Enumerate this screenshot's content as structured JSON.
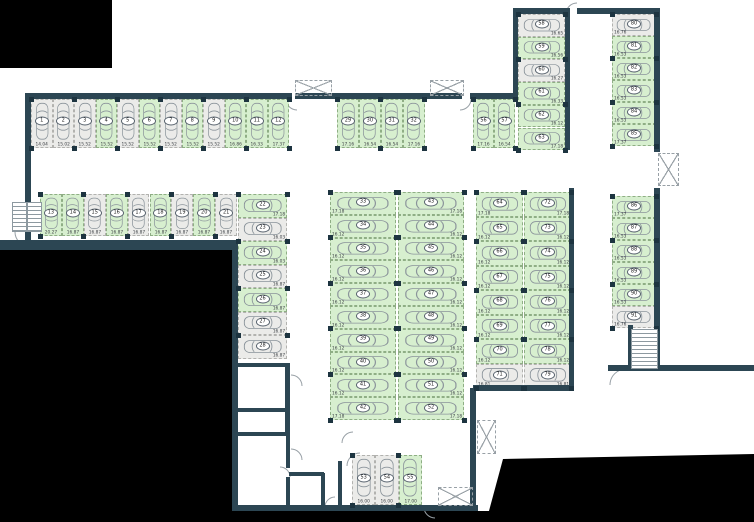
{
  "title": "Parking garage floor plan",
  "colors": {
    "free_space": "#d7efcf",
    "occupied_space": "#ebebe9",
    "wall": "#2c4653",
    "void": "#000000",
    "car_outline": "#8b949b",
    "dim_text": "#3d4146"
  },
  "icons": {
    "car": "car-icon",
    "stairs": "stairs-icon",
    "shaft": "shaft-icon",
    "door": "door-arc"
  },
  "blocks": [
    {
      "id": "row-top",
      "x": 31,
      "y": 99,
      "cw": 21.5,
      "ch": 49,
      "axis": "h",
      "dim": "bc",
      "spaces": [
        {
          "n": 1,
          "d": "14.04",
          "f": 0
        },
        {
          "n": 2,
          "d": "15.02",
          "f": 0
        },
        {
          "n": 3,
          "d": "15.52",
          "f": 0
        },
        {
          "n": 4,
          "d": "15.52",
          "f": 1
        },
        {
          "n": 5,
          "d": "15.52",
          "f": 0
        },
        {
          "n": 6,
          "d": "15.52",
          "f": 1
        },
        {
          "n": 7,
          "d": "15.52",
          "f": 0
        },
        {
          "n": 8,
          "d": "15.52",
          "f": 1
        },
        {
          "n": 9,
          "d": "15.52",
          "f": 0
        },
        {
          "n": 10,
          "d": "16.86",
          "f": 1
        },
        {
          "n": 11,
          "d": "16.33",
          "f": 1
        },
        {
          "n": 12,
          "d": "17.37",
          "f": 1
        }
      ]
    },
    {
      "id": "row-second",
      "x": 40,
      "y": 194,
      "cw": 21.9,
      "ch": 42,
      "axis": "h",
      "dim": "bc",
      "spaces": [
        {
          "n": 13,
          "d": "20.27",
          "f": 1
        },
        {
          "n": 14,
          "d": "16.87",
          "f": 1
        },
        {
          "n": 15,
          "d": "16.87",
          "f": 0
        },
        {
          "n": 16,
          "d": "16.87",
          "f": 1
        },
        {
          "n": 17,
          "d": "16.87",
          "f": 0
        },
        {
          "n": 18,
          "d": "16.87",
          "f": 1
        },
        {
          "n": 19,
          "d": "16.87",
          "f": 0
        },
        {
          "n": 20,
          "d": "16.87",
          "f": 1
        },
        {
          "n": 21,
          "d": "16.87",
          "f": 0
        }
      ]
    },
    {
      "id": "col-left",
      "x": 238,
      "y": 194,
      "cw": 49,
      "ch": 23.5,
      "axis": "v",
      "dim": "br",
      "spaces": [
        {
          "n": 22,
          "d": "17.18",
          "f": 1
        },
        {
          "n": 23,
          "d": "16.03",
          "f": 0
        },
        {
          "n": 24,
          "d": "16.03",
          "f": 1
        },
        {
          "n": 25,
          "d": "16.87",
          "f": 0
        },
        {
          "n": 26,
          "d": "16.87",
          "f": 1
        },
        {
          "n": 27,
          "d": "16.87",
          "f": 0
        },
        {
          "n": 28,
          "d": "16.87",
          "f": 0
        }
      ]
    },
    {
      "id": "row-mid-top",
      "x": 337,
      "y": 99,
      "cw": 21.9,
      "ch": 49,
      "axis": "h",
      "dim": "bc",
      "spaces": [
        {
          "n": 29,
          "d": "17.16",
          "f": 1
        },
        {
          "n": 30,
          "d": "16.54",
          "f": 1
        },
        {
          "n": 31,
          "d": "16.54",
          "f": 1
        },
        {
          "n": 32,
          "d": "17.16",
          "f": 1
        }
      ]
    },
    {
      "id": "block-mid-left",
      "x": 330,
      "y": 192,
      "cw": 66,
      "ch": 22.8,
      "axis": "v",
      "dim": "bl",
      "spaces": [
        {
          "n": 33,
          "d": "17.18",
          "f": 1
        },
        {
          "n": 34,
          "d": "16.12",
          "f": 1
        },
        {
          "n": 35,
          "d": "16.12",
          "f": 1
        },
        {
          "n": 36,
          "d": "16.12",
          "f": 1
        },
        {
          "n": 37,
          "d": "16.12",
          "f": 1
        },
        {
          "n": 38,
          "d": "16.12",
          "f": 1
        },
        {
          "n": 39,
          "d": "16.12",
          "f": 1
        },
        {
          "n": 40,
          "d": "16.12",
          "f": 1
        },
        {
          "n": 41,
          "d": "16.12",
          "f": 1
        },
        {
          "n": 42,
          "d": "17.18",
          "f": 1
        }
      ]
    },
    {
      "id": "block-mid-right",
      "x": 398,
      "y": 192,
      "cw": 66,
      "ch": 22.8,
      "axis": "v",
      "dim": "br",
      "spaces": [
        {
          "n": 43,
          "d": "17.18",
          "f": 1
        },
        {
          "n": 44,
          "d": "16.12",
          "f": 1
        },
        {
          "n": 45,
          "d": "16.12",
          "f": 1
        },
        {
          "n": 46,
          "d": "16.12",
          "f": 1
        },
        {
          "n": 47,
          "d": "16.12",
          "f": 1
        },
        {
          "n": 48,
          "d": "16.12",
          "f": 1
        },
        {
          "n": 49,
          "d": "16.12",
          "f": 1
        },
        {
          "n": 50,
          "d": "16.12",
          "f": 1
        },
        {
          "n": 51,
          "d": "16.12",
          "f": 1
        },
        {
          "n": 52,
          "d": "17.18",
          "f": 1
        }
      ]
    },
    {
      "id": "row-bottom",
      "x": 352,
      "y": 455,
      "cw": 23.3,
      "ch": 50,
      "axis": "h",
      "dim": "bc",
      "spaces": [
        {
          "n": 53,
          "d": "16.00",
          "f": 0
        },
        {
          "n": 54,
          "d": "16.00",
          "f": 0
        },
        {
          "n": 55,
          "d": "17.00",
          "f": 1
        }
      ]
    },
    {
      "id": "pair-upper-right",
      "x": 473,
      "y": 99,
      "cw": 21,
      "ch": 49,
      "axis": "h",
      "dim": "bc",
      "spaces": [
        {
          "n": 56,
          "d": "17.16",
          "f": 1
        },
        {
          "n": 57,
          "d": "16.54",
          "f": 1
        }
      ]
    },
    {
      "id": "col-upper-right",
      "x": 518,
      "y": 14,
      "cw": 47,
      "ch": 22.7,
      "axis": "v",
      "dim": "br",
      "spaces": [
        {
          "n": 58,
          "d": "16.65",
          "f": 0
        },
        {
          "n": 59,
          "d": "16.56",
          "f": 1
        },
        {
          "n": 60,
          "d": "16.27",
          "f": 0
        },
        {
          "n": 61,
          "d": "16.33",
          "f": 1
        },
        {
          "n": 62,
          "d": "16.12",
          "f": 1
        },
        {
          "n": 63,
          "d": "17.18",
          "f": 1
        }
      ]
    },
    {
      "id": "block-right-left",
      "x": 476,
      "y": 192,
      "cw": 47,
      "ch": 24.5,
      "axis": "v",
      "dim": "bl",
      "spaces": [
        {
          "n": 64,
          "d": "17.18",
          "f": 1
        },
        {
          "n": 65,
          "d": "16.12",
          "f": 1
        },
        {
          "n": 66,
          "d": "16.12",
          "f": 1
        },
        {
          "n": 67,
          "d": "16.12",
          "f": 1
        },
        {
          "n": 68,
          "d": "16.12",
          "f": 1
        },
        {
          "n": 69,
          "d": "16.12",
          "f": 1
        },
        {
          "n": 70,
          "d": "16.12",
          "f": 1
        },
        {
          "n": 71,
          "d": "16.81",
          "f": 0
        }
      ]
    },
    {
      "id": "block-right-right",
      "x": 524,
      "y": 192,
      "cw": 47,
      "ch": 24.5,
      "axis": "v",
      "dim": "br",
      "spaces": [
        {
          "n": 72,
          "d": "17.18",
          "f": 1
        },
        {
          "n": 73,
          "d": "16.12",
          "f": 1
        },
        {
          "n": 74,
          "d": "16.12",
          "f": 1
        },
        {
          "n": 75,
          "d": "16.12",
          "f": 1
        },
        {
          "n": 76,
          "d": "16.12",
          "f": 1
        },
        {
          "n": 77,
          "d": "16.12",
          "f": 1
        },
        {
          "n": 78,
          "d": "16.12",
          "f": 1
        },
        {
          "n": 79,
          "d": "16.81",
          "f": 0
        }
      ]
    },
    {
      "id": "col-far-right-top",
      "x": 612,
      "y": 14,
      "cw": 44,
      "ch": 22,
      "axis": "v",
      "dim": "bl",
      "spaces": [
        {
          "n": 80,
          "d": "16.76",
          "f": 0
        },
        {
          "n": 81,
          "d": "16.53",
          "f": 1
        },
        {
          "n": 82,
          "d": "16.53",
          "f": 1
        },
        {
          "n": 83,
          "d": "16.53",
          "f": 1
        },
        {
          "n": 84,
          "d": "16.53",
          "f": 1
        },
        {
          "n": 85,
          "d": "17.37",
          "f": 1
        }
      ]
    },
    {
      "id": "col-far-right-mid",
      "x": 612,
      "y": 196,
      "cw": 44,
      "ch": 22,
      "axis": "v",
      "dim": "bl",
      "spaces": [
        {
          "n": 86,
          "d": "17.37",
          "f": 1
        },
        {
          "n": 87,
          "d": "16.53",
          "f": 1
        },
        {
          "n": 88,
          "d": "16.53",
          "f": 1
        },
        {
          "n": 89,
          "d": "16.53",
          "f": 1
        },
        {
          "n": 90,
          "d": "16.53",
          "f": 1
        },
        {
          "n": 91,
          "d": "16.76",
          "f": 0
        }
      ]
    }
  ]
}
